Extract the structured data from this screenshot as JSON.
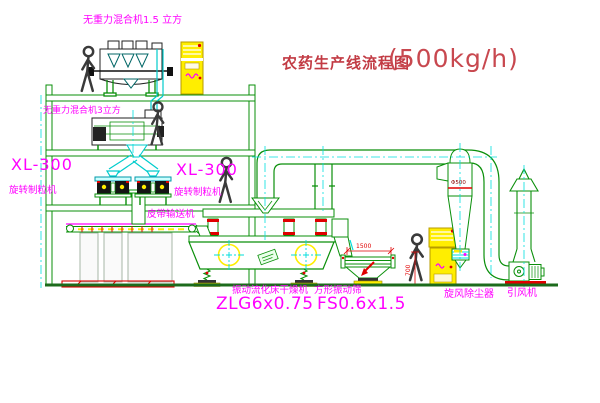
{
  "title": {
    "cn": "农药生产线流程图",
    "capacity": "(500kg/h)"
  },
  "labels": {
    "top_mixer": "无重力混合机1.5 立方",
    "mid_mixer": "无重力混合机3立方",
    "granulator_left_model": "XL-300",
    "granulator_left_name": "旋转制粒机",
    "granulator_mid_model": "XL-300",
    "granulator_mid_name": "旋转制粒机",
    "conveyor": "皮带输送机",
    "dryer_name": "振动流化床干燥机",
    "dryer_model": "ZLG6x0.75",
    "sieve_name": "方形振动筛",
    "sieve_model": "FS0.6x1.5",
    "cyclone": "旋风除尘器",
    "fan": "引风机"
  },
  "dimensions": {
    "sieve_length": "1500",
    "sieve_height": "700",
    "cyclone_diameter": "Φ500"
  },
  "colors": {
    "line_green": "#0A8F0A",
    "magenta": "#FF00FF",
    "cyan": "#00CCCC",
    "yellow": "#FFEE00",
    "red": "#E00000",
    "title_red": "#C23B44"
  }
}
